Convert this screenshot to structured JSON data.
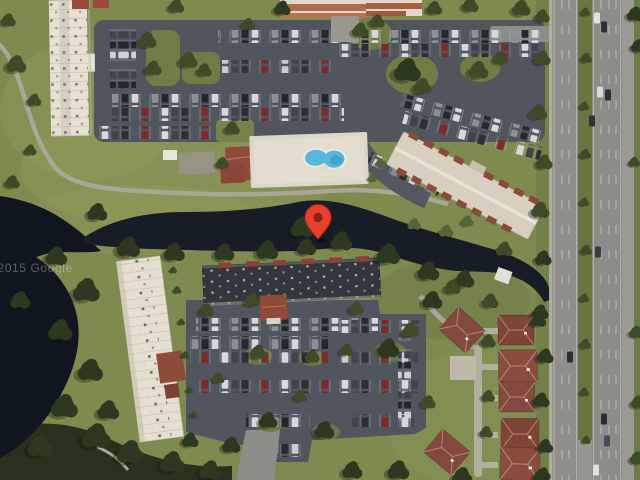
{
  "map": {
    "view_type": "satellite-aerial",
    "watermark": "©2015 Google",
    "pin": {
      "icon": "location-pin-icon",
      "transform": "translate(318,239)",
      "color": "#e8402d",
      "inner_color": "#8c1f14"
    },
    "palette": {
      "grass": "#7f8a4f",
      "canal_water": "#161d26",
      "pond_water": "#10161f",
      "parking_asphalt": "#51555d",
      "highway_asphalt": "#8f8e8a",
      "light_roof": "#e6e1d2",
      "dark_roof": "#34363d",
      "tile_roof": "#8f4a3a",
      "orange_tile_roof": "#b06a48",
      "pool_water": "#58b6da",
      "tree_canopy": "#2c3820",
      "path": "#aaa796"
    }
  }
}
